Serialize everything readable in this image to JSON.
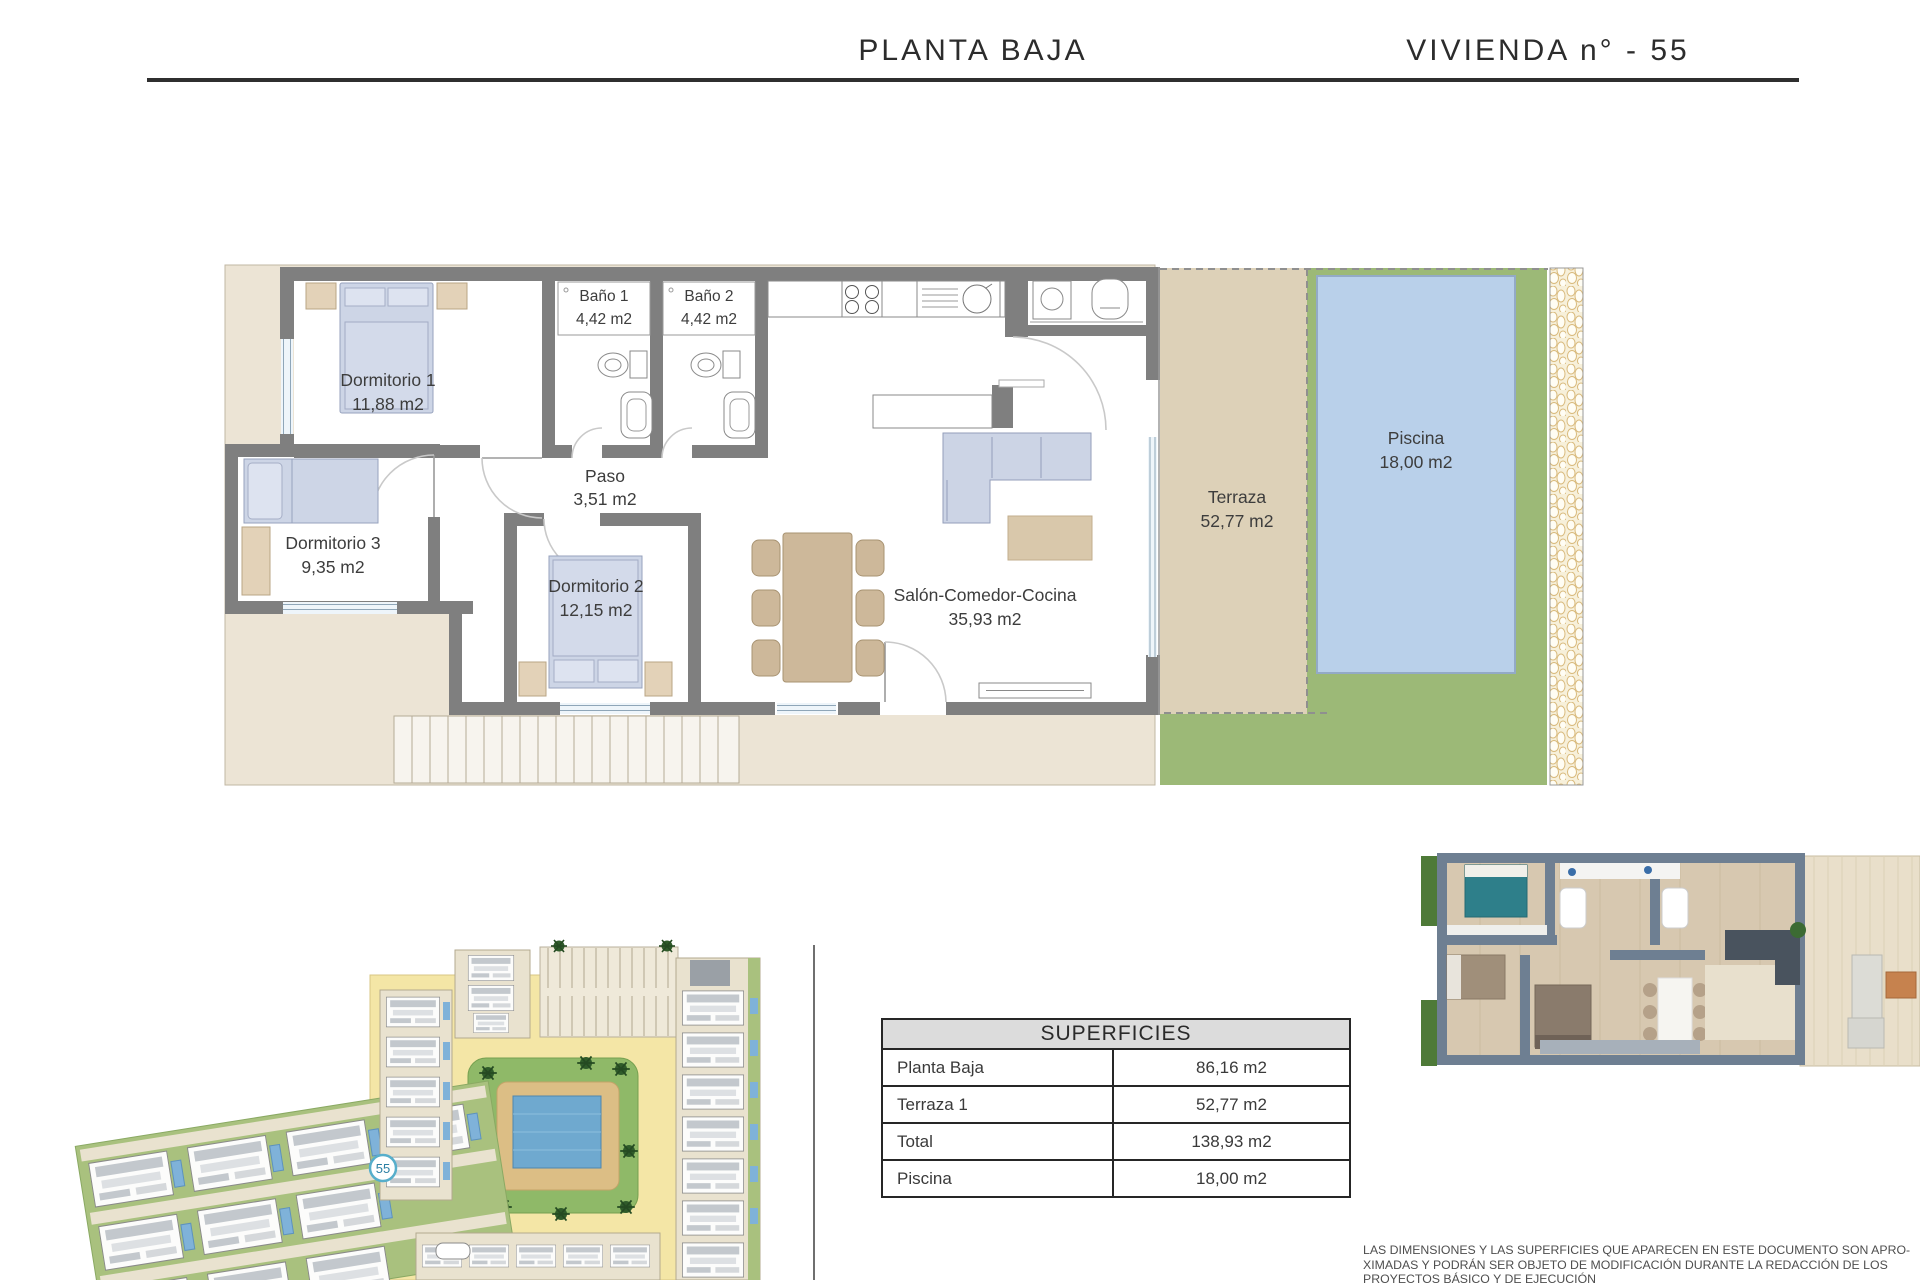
{
  "header": {
    "left_title": "PLANTA BAJA",
    "right_title": "VIVIENDA n° - 55"
  },
  "floor_plan": {
    "rooms": [
      {
        "name": "Dormitorio 1",
        "area": "11,88 m2"
      },
      {
        "name": "Baño 1",
        "area": "4,42 m2"
      },
      {
        "name": "Baño 2",
        "area": "4,42 m2"
      },
      {
        "name": "Paso",
        "area": "3,51 m2"
      },
      {
        "name": "Dormitorio 3",
        "area": "9,35 m2"
      },
      {
        "name": "Dormitorio 2",
        "area": "12,15 m2"
      },
      {
        "name": "Salón-Comedor-Cocina",
        "area": "35,93 m2"
      },
      {
        "name": "Terraza",
        "area": "52,77 m2"
      },
      {
        "name": "Piscina",
        "area": "18,00 m2"
      }
    ]
  },
  "site_plan": {
    "unit_marker": "55"
  },
  "surfaces_table": {
    "title": "SUPERFICIES",
    "rows": [
      {
        "label": "Planta Baja",
        "value": "86,16 m2"
      },
      {
        "label": "Terraza 1",
        "value": "52,77 m2"
      },
      {
        "label": "Total",
        "value": "138,93 m2"
      },
      {
        "label": "Piscina",
        "value": "18,00 m2"
      }
    ]
  },
  "disclaimer": {
    "line1": "LAS DIMENSIONES Y LAS SUPERFICIES QUE APARECEN EN ESTE DOCUMENTO SON APRO-",
    "line2": "XIMADAS Y PODRÁN SER OBJETO DE MODIFICACIÓN DURANTE LA REDACCIÓN DE LOS",
    "line3": "PROYECTOS BÁSICO Y DE EJECUCIÓN"
  },
  "colors": {
    "wall_grey": "#7f7f7f",
    "plot_beige": "#ece4d5",
    "terrace_tan": "#ddd1b8",
    "lawn_green": "#9cb977",
    "pool_blue": "#b9d0ea",
    "road_yellow": "#f4e6a6",
    "furniture_blue": "#cdd5e6",
    "furniture_tan": "#cdb89a",
    "marker_blue": "#57aecb"
  }
}
